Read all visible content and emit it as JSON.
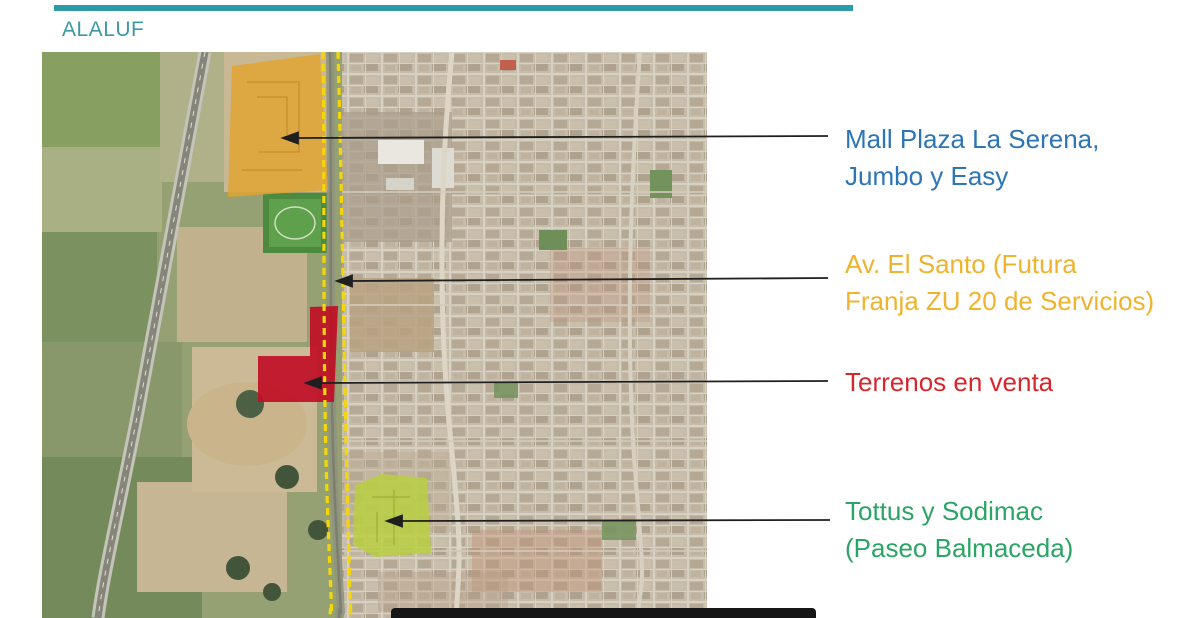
{
  "header": {
    "title": "ALALUF",
    "title_color": "#3E98A8",
    "accent_color": "#2D9AA7"
  },
  "map": {
    "description": "Aerial satellite view of La Serena: rural fields and Route 5 highway on the left, Av. El Santo corridor in the middle, dense urban grid on the right",
    "overlays": {
      "mall": {
        "name": "Mall Plaza La Serena, Jumbo y Easy site",
        "color": "#E2A430"
      },
      "avenue": {
        "name": "Av. El Santo future ZU 20 service strip (dashed boundary)",
        "color": "#F4D60C"
      },
      "terrenos": {
        "name": "Terrenos en venta (land for sale)",
        "color": "#C00E26"
      },
      "tottus": {
        "name": "Tottus y Sodimac - Paseo Balmaceda site",
        "color": "#B9CF41"
      }
    }
  },
  "annotations": {
    "mall": {
      "line1": "Mall Plaza La Serena,",
      "line2": "Jumbo y Easy",
      "color": "#2E75B6"
    },
    "avenue": {
      "line1": "Av. El Santo (Futura",
      "line2": "Franja ZU 20 de Servicios)",
      "color": "#EFB32D"
    },
    "terrenos": {
      "line1": "Terrenos en venta",
      "color": "#D7272D"
    },
    "tottus": {
      "line1": "Tottus y Sodimac",
      "line2": "(Paseo Balmaceda)",
      "color": "#2AA565"
    }
  },
  "footer": {
    "bar_color": "#161616"
  }
}
